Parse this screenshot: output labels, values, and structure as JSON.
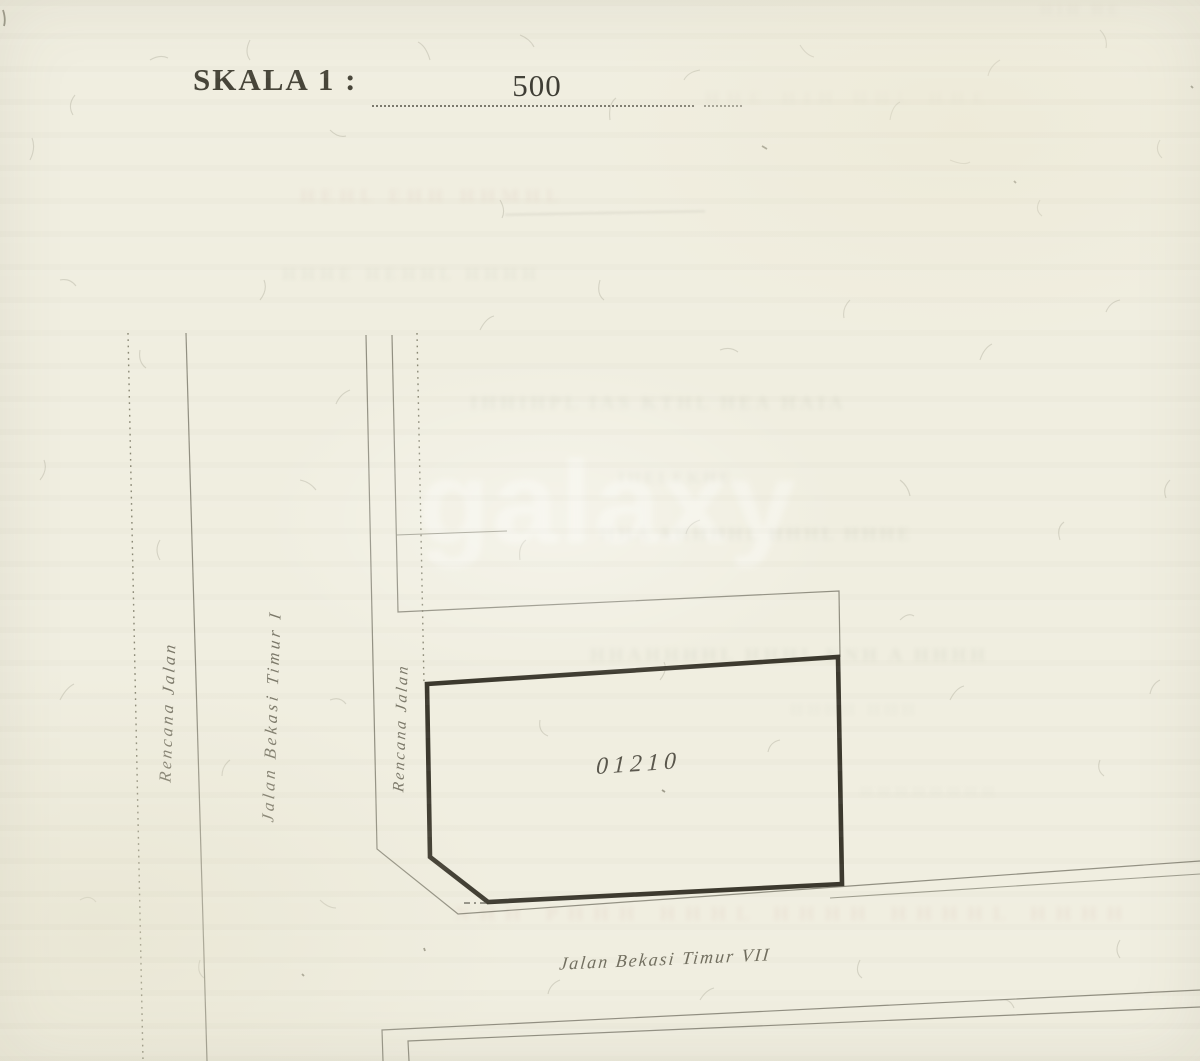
{
  "header": {
    "skala_label": "SKALA 1 :",
    "scale_value": "500"
  },
  "plot": {
    "parcel_number": "01210"
  },
  "streets": {
    "left_road": "Rencana Jalan",
    "cross_road": "Jalan Bekasi Timur I",
    "inner_road": "Rencana Jalan",
    "bottom_road": "Jalan Bekasi Timur VII"
  },
  "watermark": {
    "text": "galaxy"
  },
  "illegible_bleed_through": {
    "items": [
      {
        "text": "HIH HE"
      },
      {
        "text": "HHE HIH HHL HHE"
      },
      {
        "text": "HEHL EHH HHMHL"
      },
      {
        "text": "HHHE HEHHL HHHH"
      },
      {
        "text": "IHHIHPL IAS KTHL HEA HAIA"
      },
      {
        "text": "IHELEKHE"
      },
      {
        "text": "HHA AHHHHL HHHL HHHE"
      },
      {
        "text": "HHAHHHHL HHHL KNH A HHHH"
      },
      {
        "text": "HHHH HHH"
      },
      {
        "text": "HHHHHHHH"
      },
      {
        "text": "NHH PHHH HHHL HHHH HHHHL HHHH"
      }
    ]
  },
  "colors": {
    "paper": "#f0eee0",
    "ink_heavy": "#3c392e",
    "ink_light": "#8b897b",
    "label_ink": "#7b7869",
    "header_ink": "#474539",
    "watermark_white": "#ffffff",
    "bleed_green": "#99a090",
    "bleed_pink": "#c4978f"
  }
}
